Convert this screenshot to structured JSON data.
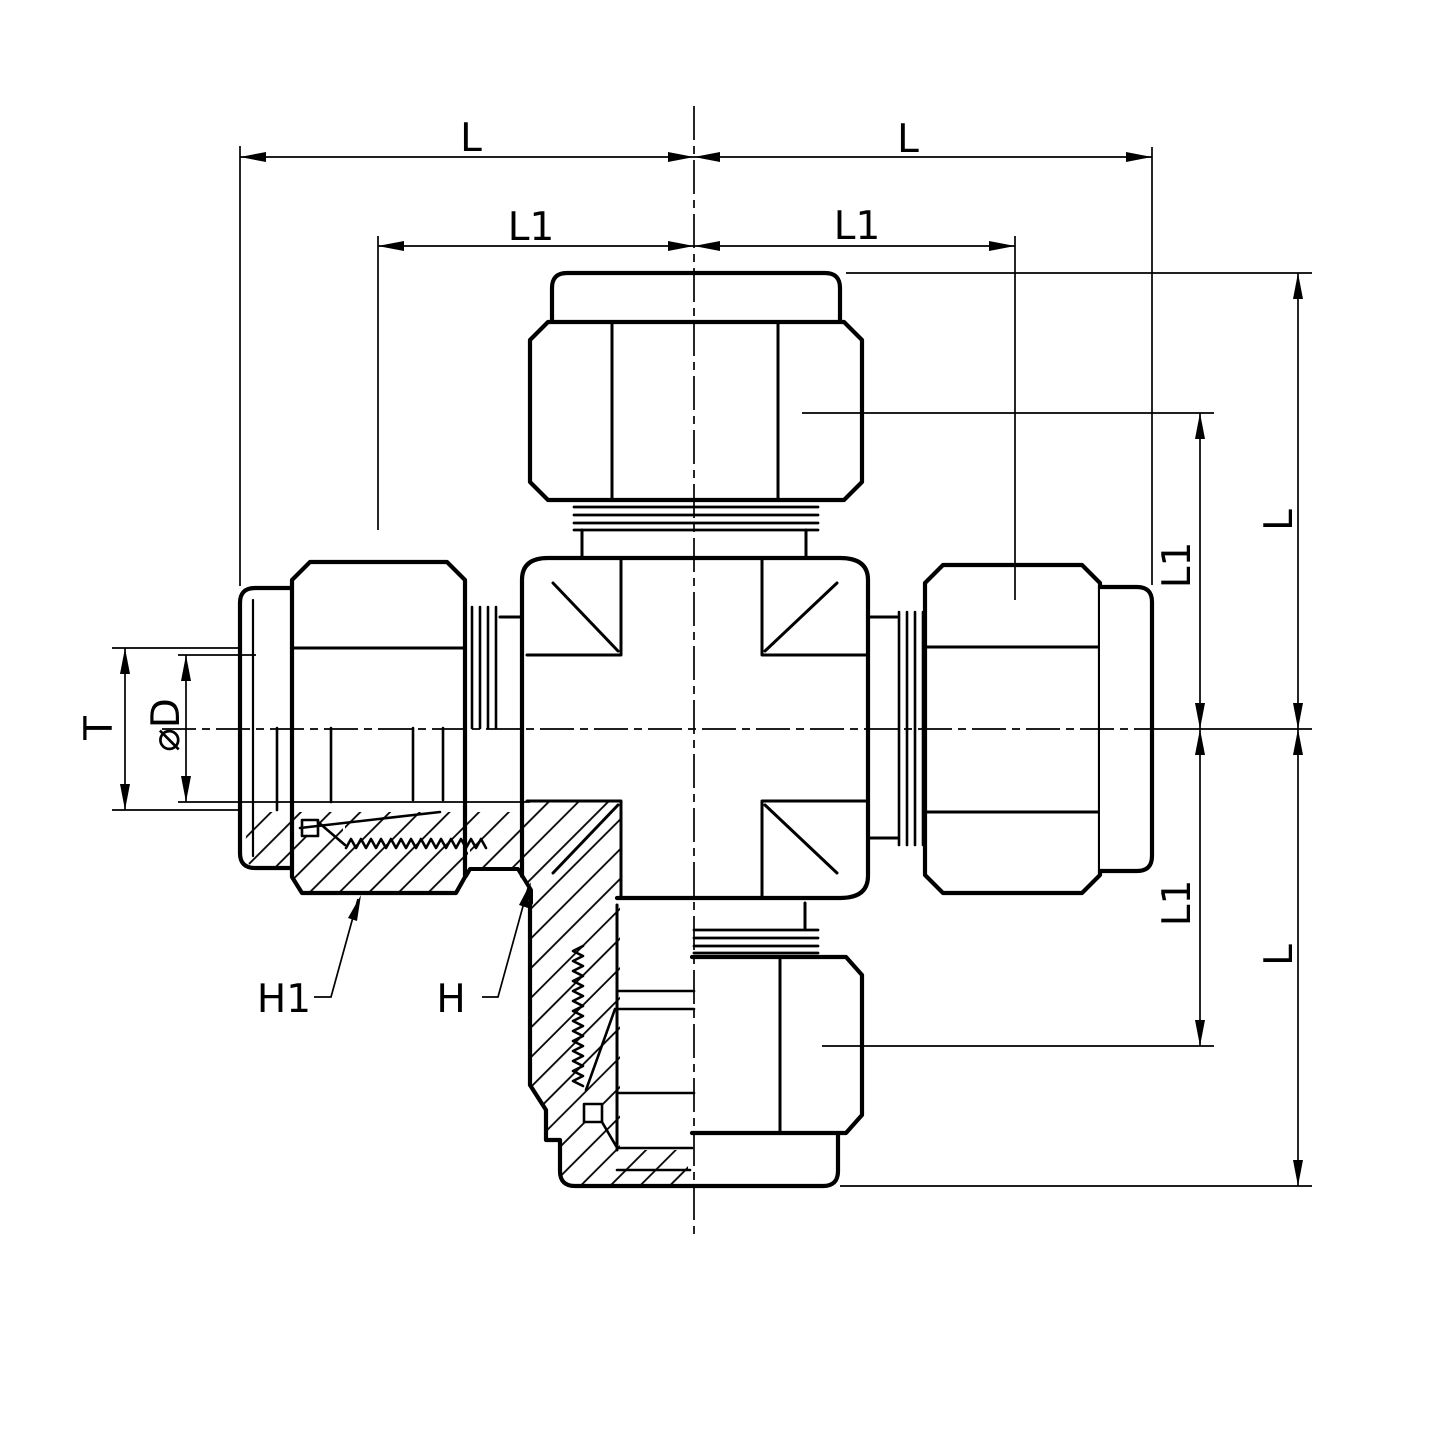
{
  "figure": {
    "kind": "engineering-section-drawing",
    "subject": "union-cross-tube-fitting-half-section",
    "background": "#ffffff",
    "line_color": "#000000"
  },
  "dims": {
    "top_left_L": "L",
    "top_left_L1": "L1",
    "top_right_L": "L",
    "top_right_L1": "L1",
    "right_upper_L1": "L1",
    "right_upper_L": "L",
    "right_lower_L1": "L1",
    "right_lower_L": "L",
    "tube_T": "T",
    "bore_D": "⌀D",
    "callout_H1": "H1",
    "callout_H": "H"
  }
}
